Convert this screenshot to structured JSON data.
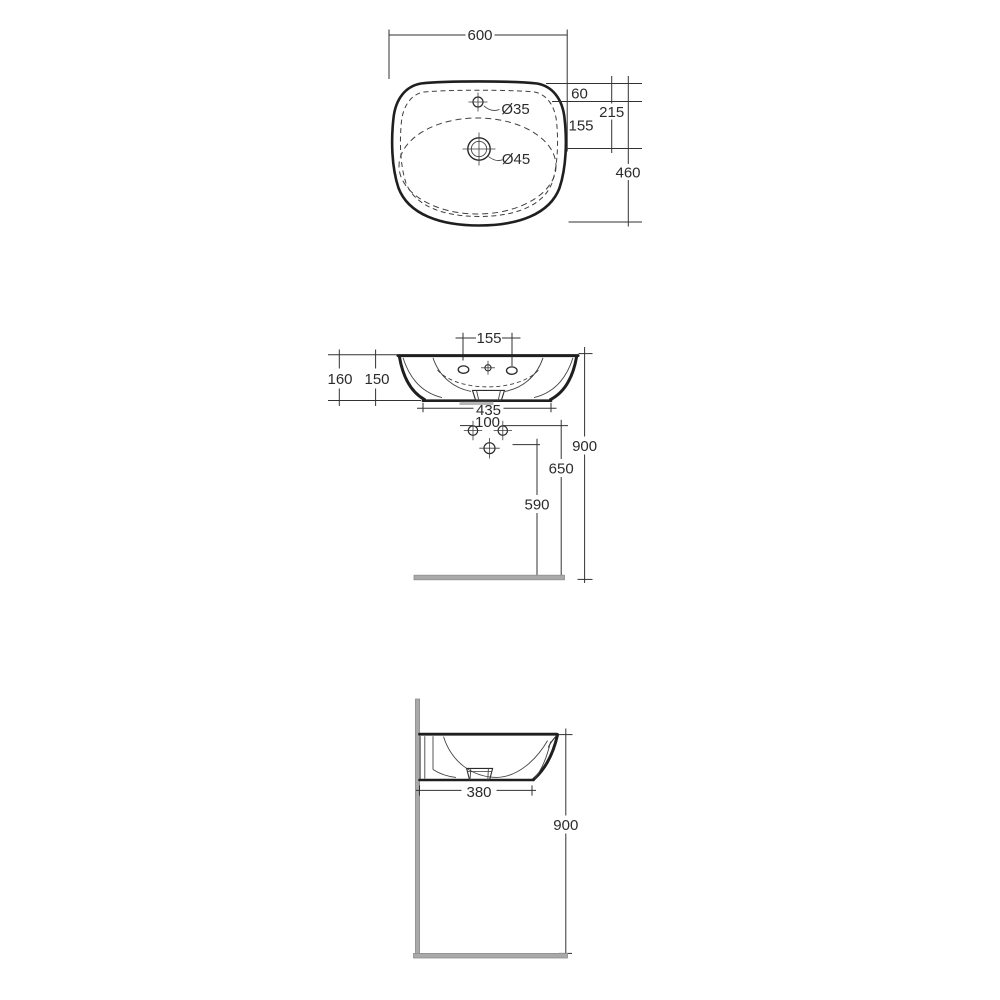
{
  "top_view": {
    "width": "600",
    "depth": "460",
    "edge_to_tap": "60",
    "edge_to_drain": "215",
    "tap_to_drain": "155",
    "tap_hole": "Ø35",
    "drain_hole": "Ø45"
  },
  "front_view": {
    "tap_spacing": "155",
    "height_total": "160",
    "height_body": "150",
    "base_width": "435",
    "fixing_spacing": "100",
    "height_rim": "900",
    "height_fixing": "650",
    "height_drain": "590"
  },
  "side_view": {
    "depth_base": "380",
    "height_rim": "900"
  },
  "colors": {
    "line": "#2b2b2b",
    "gray_wall_floor": "#a9a9a9",
    "background": "#ffffff"
  }
}
